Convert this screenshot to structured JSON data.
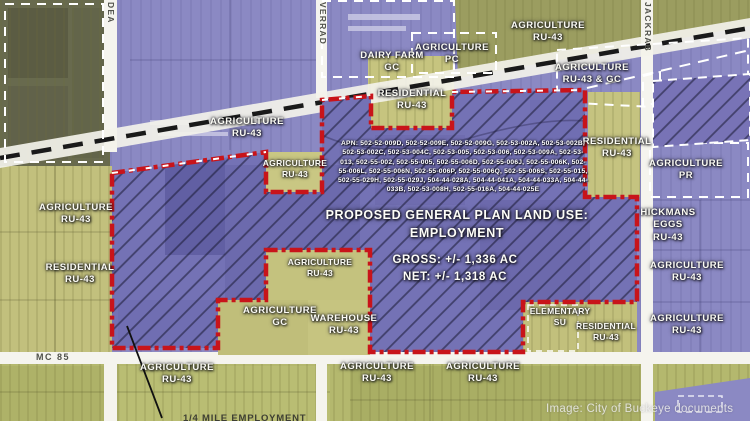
{
  "roads": {
    "vertical_left": "DEA",
    "vertical_center": "VERRAD",
    "vertical_right": "JACKRAB",
    "highway": "MC 85"
  },
  "zones": [
    {
      "line1": "AGRICULTURE",
      "line2": "RU-43"
    },
    {
      "line1": "AGRICULTURE",
      "line2": "PC"
    },
    {
      "line1": "DAIRY FARM",
      "line2": "GC"
    },
    {
      "line1": "AGRICULTURE",
      "line2": "RU-43 & GC"
    },
    {
      "line1": "RESIDENTIAL",
      "line2": "RU-43"
    },
    {
      "line1": "AGRICULTURE",
      "line2": "RU-43"
    },
    {
      "line1": "AGRICULTURE",
      "line2": "RU-43"
    },
    {
      "line1": "RESIDENTIAL",
      "line2": "RU-43"
    },
    {
      "line1": "AGRICULTURE",
      "line2": "PR"
    },
    {
      "line1": "HICKMANS",
      "line2": "EGGS",
      "line3": "RU-43"
    },
    {
      "line1": "AGRICULTURE",
      "line2": "RU-43"
    },
    {
      "line1": "RESIDENTIAL",
      "line2": "RU-43"
    },
    {
      "line1": "AGRICULTURE",
      "line2": "RU-43"
    },
    {
      "line1": "AGRICULTURE",
      "line2": "GC"
    },
    {
      "line1": "WAREHOUSE",
      "line2": "RU-43"
    },
    {
      "line1": "AGRICULTURE",
      "line2": "RU-43"
    },
    {
      "line1": "AGRICULTURE",
      "line2": "RU-43"
    },
    {
      "line1": "ELEMENTARY",
      "line2": "SU"
    },
    {
      "line1": "RESIDENTIAL",
      "line2": "RU-43"
    },
    {
      "line1": "AGRICULTURE",
      "line2": "RU-43"
    },
    {
      "line1": "AGRICULTURE",
      "line2": "RU-43"
    },
    {
      "line1": "AGRICULTURE",
      "line2": "RU-43"
    }
  ],
  "proposal": {
    "apn": "APN: 502-52-009D, 502-52-009E, 502-52-009G, 502-53-002A, 502-53-002B, 502-53-002C, 502-53-004C, 502-53-005, 502-53-006, 502-53-009A, 502-53-013, 502-55-002, 502-55-005, 502-55-006D, 502-55-006J, 502-55-006K, 502-55-006L, 502-55-006N, 502-55-006P, 502-55-006Q, 502-55-006S, 502-55-015, 502-55-029H, 502-55-029J, 504-44-028A, 504-44-041A, 504-44-033A, 504-44-033B, 502-53-008H, 502-55-016A, 504-44-025E",
    "title_line1": "PROPOSED GENERAL PLAN LAND USE:",
    "title_line2": "EMPLOYMENT",
    "gross": "GROSS: +/- 1,336 AC",
    "net": "NET: +/- 1,318 AC"
  },
  "callout": {
    "label": "1/4 MILE EMPLOYMENT"
  },
  "watermark": "Image: City of Buckeye documents",
  "colors": {
    "boundary_red": "#C8141A",
    "employment_purple": "#7472B5",
    "agriculture_yellow": "#C2C07D",
    "rural_olive": "#686A4E",
    "road_white": "#F5F4EE"
  }
}
